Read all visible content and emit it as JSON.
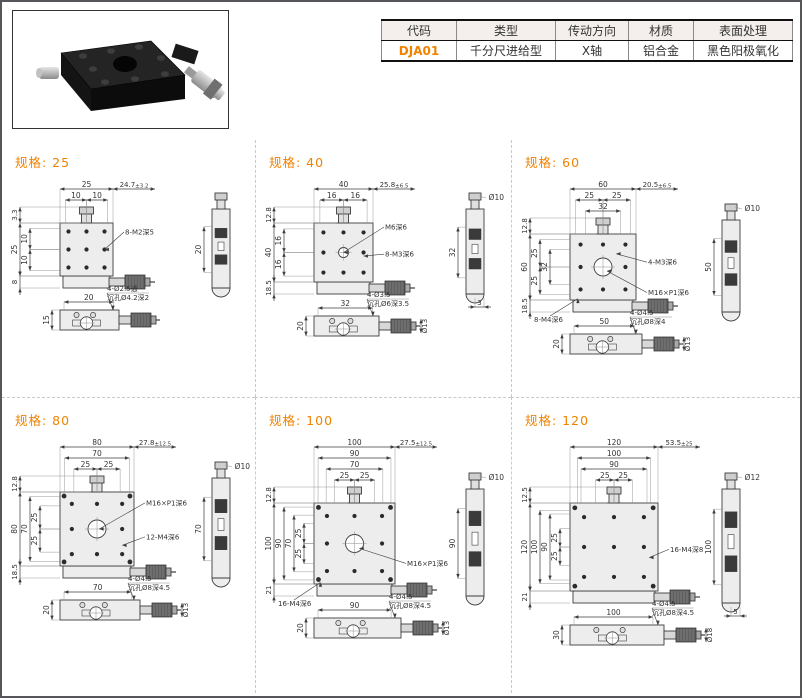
{
  "colors": {
    "accent": "#f08300",
    "line": "#3c3c3c",
    "thin": "#8c8c8c",
    "fill_light": "#ededed",
    "fill_dark": "#3a3a3a",
    "metal": "#d8d8d8",
    "table_header_bg": "#f4efec",
    "page_border": "#55565a",
    "divider": "#c9c9c9"
  },
  "header": {
    "table": {
      "headers": [
        "代码",
        "类型",
        "传动方向",
        "材质",
        "表面处理"
      ],
      "row": [
        "DJA01",
        "千分尺进给型",
        "X轴",
        "铝合金",
        "黑色阳极氧化"
      ]
    }
  },
  "spec_label": "规格:",
  "panels": [
    {
      "size": "25",
      "plan": {
        "top": [
          [
            "25"
          ],
          [
            "10",
            "10"
          ]
        ],
        "travel": "24.7±3.2",
        "left_top": "3.3",
        "left": [
          [
            "25"
          ],
          [
            "10",
            "10"
          ]
        ],
        "left_bottom": "8",
        "callouts": [
          {
            "t": "8-M2深5",
            "x": 0.84,
            "y": 0.5,
            "ly": 0.16
          }
        ],
        "center": "dot"
      },
      "side": {
        "dia": "",
        "height": "20",
        "foot": ""
      },
      "bottom": {
        "width": "20",
        "callout": [
          "4-Ø2.5通",
          "沉孔Ø4.2深2"
        ],
        "left": "15",
        "dia": ""
      }
    },
    {
      "size": "40",
      "plan": {
        "top": [
          [
            "40"
          ],
          [
            "16",
            "16"
          ]
        ],
        "travel": "25.8±6.5",
        "left_top": "12.8",
        "left": [
          [
            "40"
          ],
          [
            "16",
            "16"
          ]
        ],
        "left_bottom": "18.5",
        "callouts": [
          {
            "t": "M6深6",
            "x": 0.5,
            "y": 0.5,
            "ly": 0.06
          },
          {
            "t": "8-M3深6",
            "x": 0.84,
            "y": 0.56,
            "ly": 0.52
          }
        ],
        "center": "M6"
      },
      "side": {
        "dia": "Ø10",
        "height": "32",
        "foot": "3"
      },
      "bottom": {
        "width": "32",
        "callout": [
          "4-Ø3.5",
          "沉孔Ø6深3.5"
        ],
        "left": "20",
        "dia": "Ø13"
      }
    },
    {
      "size": "60",
      "plan": {
        "top": [
          [
            "60"
          ],
          [
            "25",
            "25"
          ],
          [
            "32"
          ]
        ],
        "travel": "20.5±6.5",
        "left_top": "12.8",
        "left": [
          [
            "60"
          ],
          [
            "25",
            "25"
          ],
          [
            "32"
          ]
        ],
        "left_bottom": "18.5",
        "callouts": [
          {
            "t": "4-M3深6",
            "x": 0.7,
            "y": 0.3,
            "ly": 0.42
          },
          {
            "t": "M16×P1深6",
            "x": 0.56,
            "y": 0.56,
            "ly": 0.88
          },
          {
            "t": "8-M4深6",
            "x": 0.12,
            "y": 0.98,
            "ly": 0,
            "pos": "bl"
          }
        ],
        "center": "M16"
      },
      "side": {
        "dia": "Ø10",
        "height": "50",
        "foot": ""
      },
      "bottom": {
        "width": "50",
        "callout": [
          "4-Ø4.5",
          "沉孔Ø8深4"
        ],
        "left": "20",
        "dia": "Ø13"
      }
    },
    {
      "size": "80",
      "plan": {
        "top": [
          [
            "80"
          ],
          [
            "70"
          ],
          [
            "25",
            "25"
          ]
        ],
        "travel": "27.8±12.5",
        "left_top": "12.8",
        "left": [
          [
            "80"
          ],
          [
            "70"
          ],
          [
            "25",
            "25"
          ]
        ],
        "left_bottom": "18.5",
        "callouts": [
          {
            "t": "M16×P1深6",
            "x": 0.53,
            "y": 0.5,
            "ly": 0.14
          },
          {
            "t": "12-M4深6",
            "x": 0.84,
            "y": 0.72,
            "ly": 0.6
          }
        ],
        "center": "M16"
      },
      "side": {
        "dia": "Ø10",
        "height": "70",
        "foot": ""
      },
      "bottom": {
        "width": "70",
        "callout": [
          "4-Ø4.5",
          "沉孔Ø8深4.5"
        ],
        "left": "20",
        "dia": "Ø13"
      }
    },
    {
      "size": "100",
      "plan": {
        "top": [
          [
            "100"
          ],
          [
            "90"
          ],
          [
            "70"
          ],
          [
            "25",
            "25"
          ]
        ],
        "travel": "27.5±12.5",
        "left_top": "12.8",
        "left": [
          [
            "100"
          ],
          [
            "90"
          ],
          [
            "70"
          ],
          [
            "25",
            "25"
          ]
        ],
        "left_bottom": "21",
        "callouts": [
          {
            "t": "M16×P1深6",
            "x": 0.56,
            "y": 0.56,
            "ly": 0.74
          },
          {
            "t": "16-M4深6",
            "x": 0.08,
            "y": 0.98,
            "ly": 0,
            "pos": "bl"
          }
        ],
        "center": "M16"
      },
      "side": {
        "dia": "Ø10",
        "height": "90",
        "foot": ""
      },
      "bottom": {
        "width": "90",
        "callout": [
          "4-Ø4.5",
          "沉孔Ø8深4.5"
        ],
        "left": "20",
        "dia": "Ø13"
      }
    },
    {
      "size": "120",
      "plan": {
        "top": [
          [
            "120"
          ],
          [
            "100"
          ],
          [
            "90"
          ],
          [
            "25",
            "25"
          ]
        ],
        "travel": "53.5±25",
        "left_top": "12.5",
        "left": [
          [
            "120"
          ],
          [
            "100"
          ],
          [
            "90"
          ],
          [
            "25",
            "25"
          ]
        ],
        "left_bottom": "21",
        "callouts": [
          {
            "t": "16-M4深8",
            "x": 0.9,
            "y": 0.62,
            "ly": 0.52
          }
        ],
        "center": "dot"
      },
      "side": {
        "dia": "Ø12",
        "height": "100",
        "foot": "5"
      },
      "bottom": {
        "width": "100",
        "callout": [
          "4-Ø4.5",
          "沉孔Ø8深4.5"
        ],
        "left": "30",
        "dia": "Ø18"
      }
    }
  ]
}
